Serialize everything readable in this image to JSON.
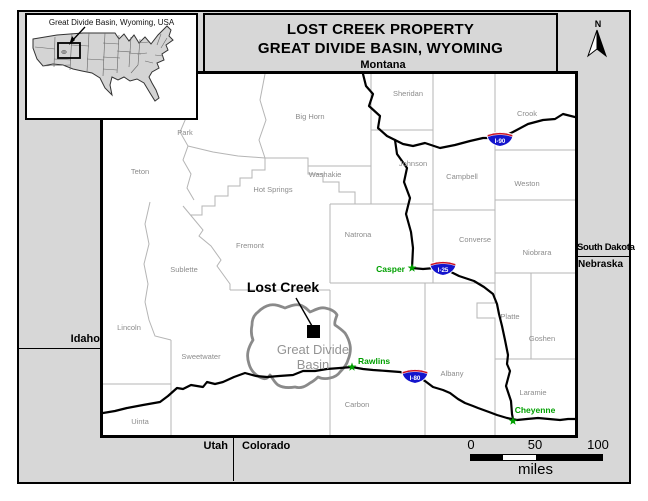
{
  "title": {
    "line1": "LOST CREEK PROPERTY",
    "line2": "GREAT DIVIDE BASIN, WYOMING"
  },
  "inset": {
    "label": "Great Divide Basin, Wyoming, USA"
  },
  "compass": {
    "n": "N"
  },
  "neighbors": {
    "montana": "Montana",
    "idaho": "Idaho",
    "south_dakota": "South Dakota",
    "nebraska": "Nebraska",
    "utah": "Utah",
    "colorado": "Colorado"
  },
  "map": {
    "property": {
      "label": "Lost Creek"
    },
    "basin": {
      "line1": "Great Divide",
      "line2": "Basin"
    },
    "counties": [
      {
        "name": "Park"
      },
      {
        "name": "Big Horn"
      },
      {
        "name": "Sheridan"
      },
      {
        "name": "Crook"
      },
      {
        "name": "Teton"
      },
      {
        "name": "Washakie"
      },
      {
        "name": "Johnson"
      },
      {
        "name": "Campbell"
      },
      {
        "name": "Weston"
      },
      {
        "name": "Hot Springs"
      },
      {
        "name": "Fremont"
      },
      {
        "name": "Natrona"
      },
      {
        "name": "Converse"
      },
      {
        "name": "Niobrara"
      },
      {
        "name": "Sublette"
      },
      {
        "name": "Lincoln"
      },
      {
        "name": "Sweetwater"
      },
      {
        "name": "Carbon"
      },
      {
        "name": "Albany"
      },
      {
        "name": "Platte"
      },
      {
        "name": "Goshen"
      },
      {
        "name": "Laramie"
      },
      {
        "name": "Uinta"
      }
    ],
    "cities": [
      {
        "name": "Casper"
      },
      {
        "name": "Rawlins"
      },
      {
        "name": "Cheyenne"
      }
    ],
    "highways": [
      {
        "label": "I-90"
      },
      {
        "label": "I-25"
      },
      {
        "label": "I-80"
      }
    ]
  },
  "scalebar": {
    "ticks": [
      "0",
      "50",
      "100"
    ],
    "unit": "miles"
  },
  "colors": {
    "margin_gray": "#d7d7d7",
    "city_green": "#00a000",
    "shield_blue": "#1414cc",
    "shield_red": "#cc1122",
    "basin_gray": "#8a8a8a",
    "county_line_gray": "#b5b5b5"
  }
}
